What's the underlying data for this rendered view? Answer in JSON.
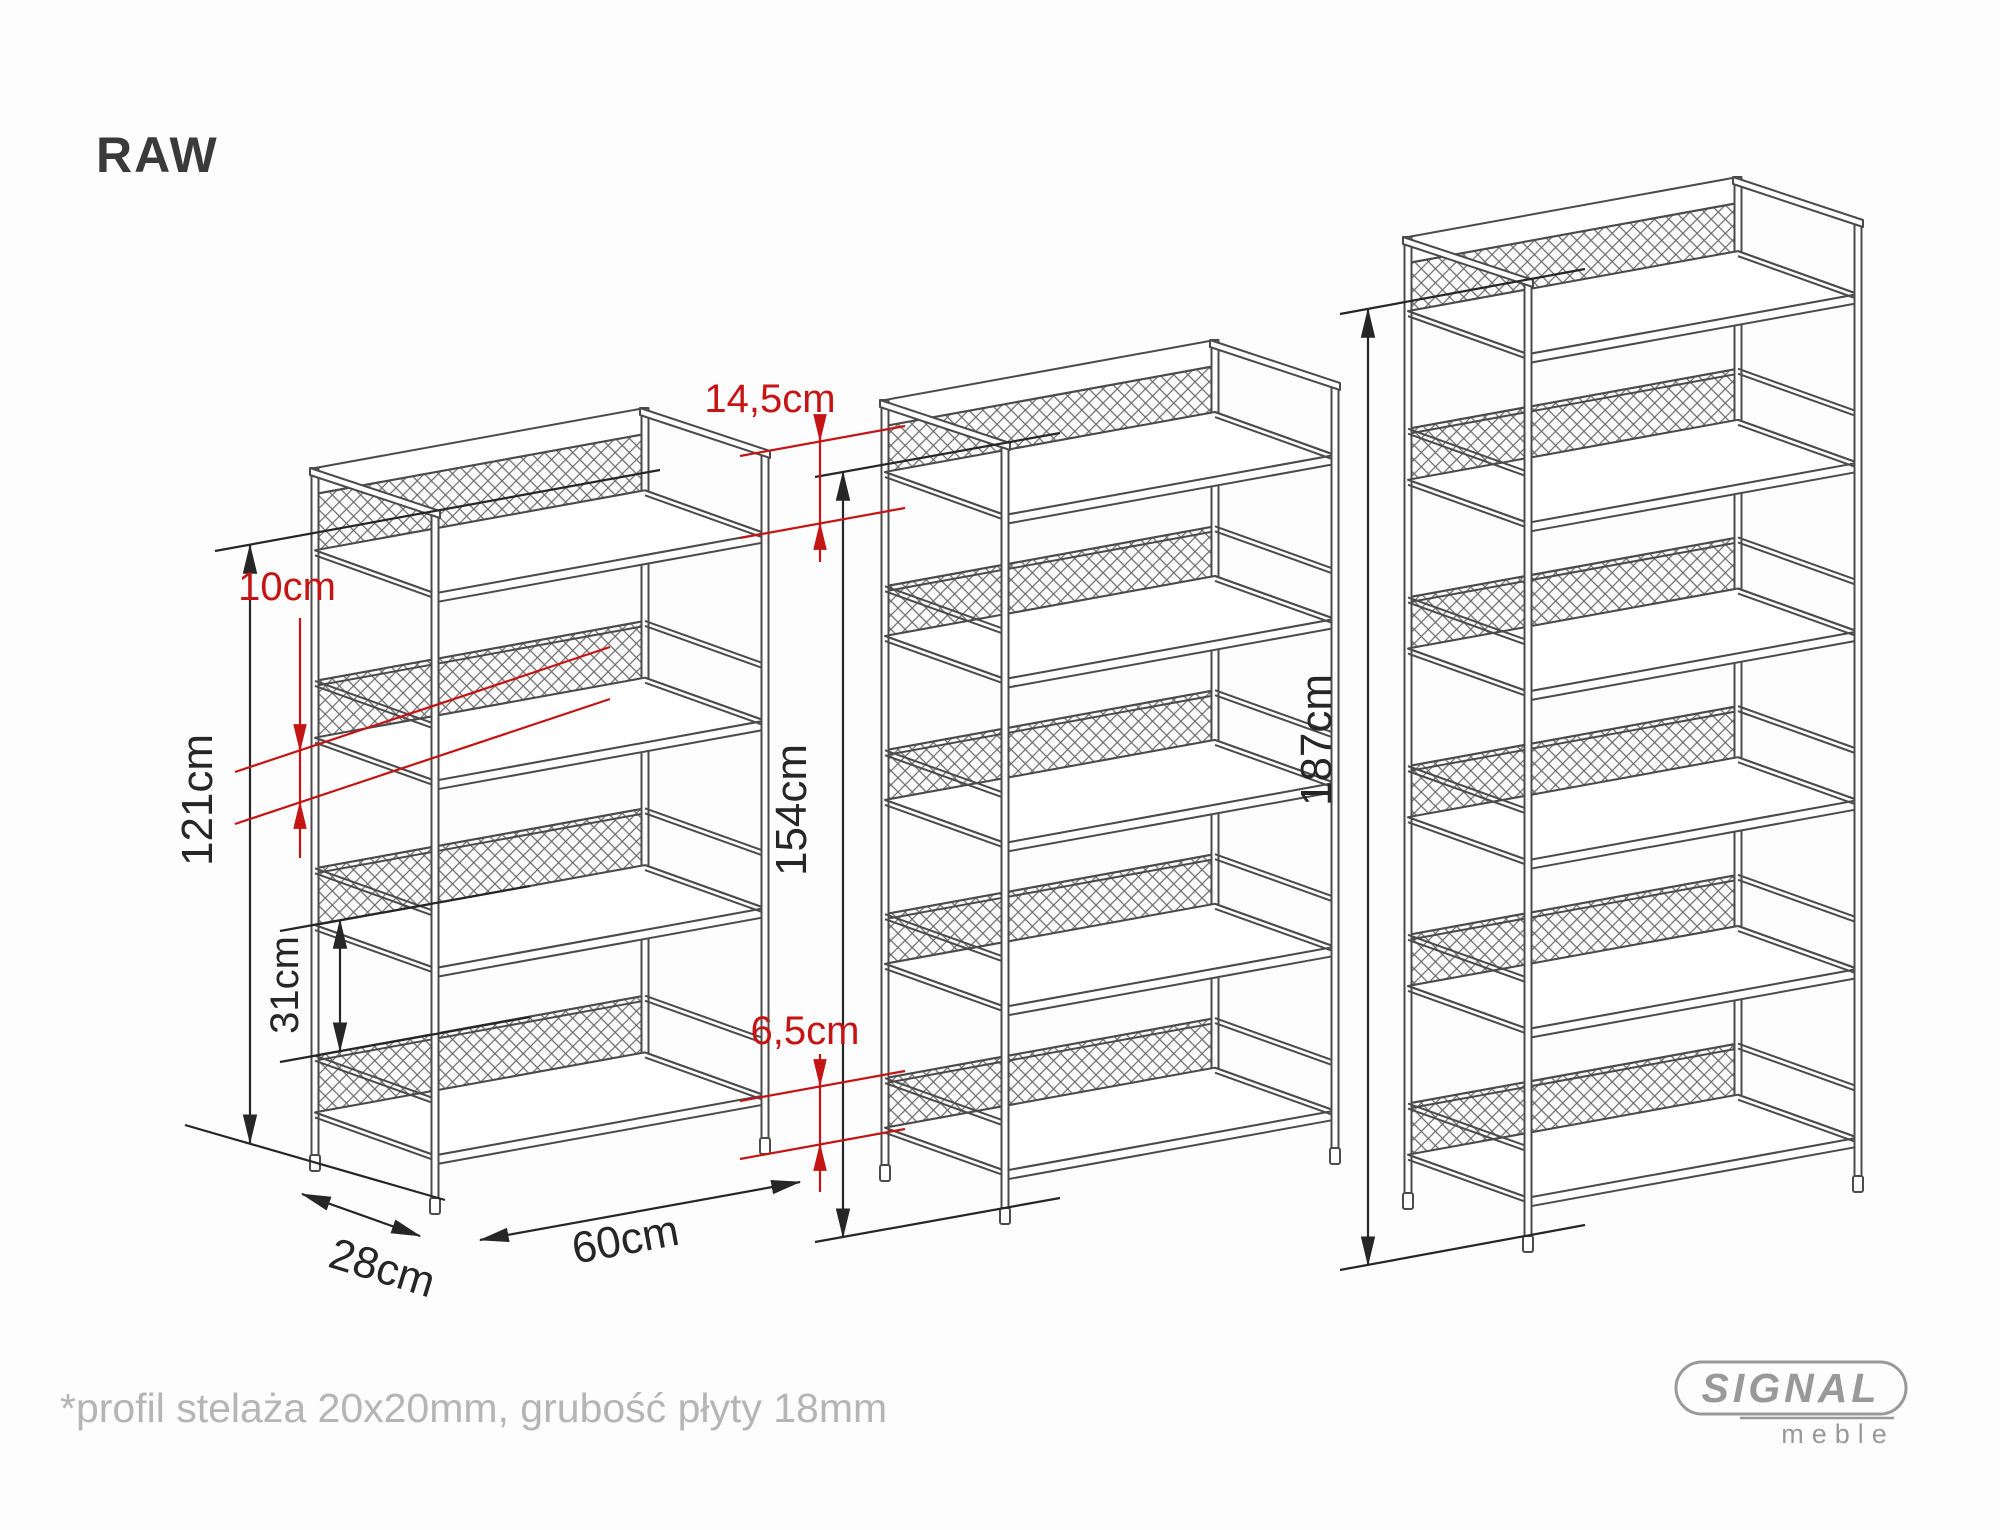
{
  "page": {
    "title": "RAW",
    "footnote": "*profil stelaża 20x20mm, grubość płyty 18mm"
  },
  "logo": {
    "brand": "SIGNAL",
    "sub": "meble"
  },
  "colors": {
    "line": "#4b4b4b",
    "dim_black": "#262626",
    "dim_red": "#c41414",
    "note": "#b5b5b5",
    "logo": "#999999",
    "background": "#fdfdfd"
  },
  "diagram": {
    "product": "RAW",
    "units": [
      {
        "id": "shelf-121",
        "label": "121cm",
        "height_cm": 121,
        "boards": 4,
        "x": 315,
        "y_top": 468,
        "y_base": 1155
      },
      {
        "id": "shelf-154",
        "label": "154cm",
        "height_cm": 154,
        "boards": 5,
        "x": 885,
        "y_top": 400,
        "y_base": 1165
      },
      {
        "id": "shelf-187",
        "label": "187cm",
        "height_cm": 187,
        "boards": 6,
        "x": 1408,
        "y_top": 237,
        "y_base": 1193
      }
    ],
    "dimensions_cm": {
      "top_offset": 14.5,
      "mesh_height": 10,
      "shelf_gap": 31,
      "bottom_clearance": 6.5,
      "depth": 28,
      "width": 60,
      "module_pitch": 33
    },
    "annotations": {
      "top_offset": "14,5cm",
      "mesh_height": "10cm",
      "shelf_gap": "31cm",
      "bottom_clearance": "6,5cm",
      "depth": "28cm",
      "width": "60cm"
    }
  }
}
